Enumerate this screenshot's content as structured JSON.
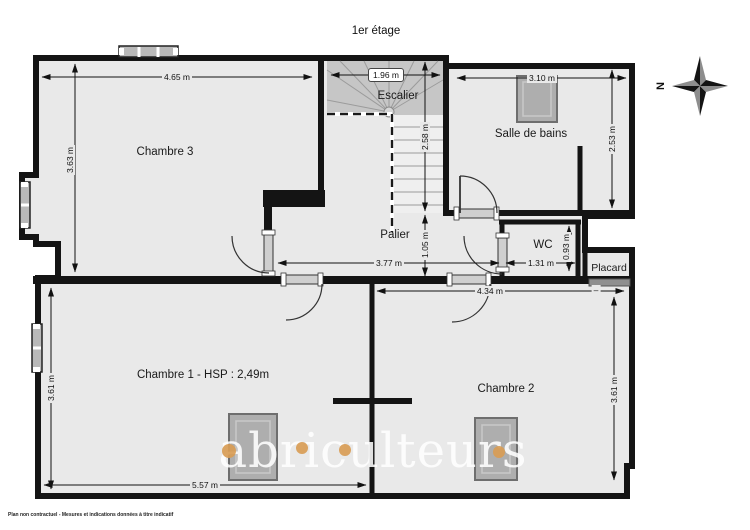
{
  "title": "1er étage",
  "disclaimer": "Plan non contractuel - Mesures et indications données à titre indicatif",
  "watermark": {
    "text": "abriculteurs",
    "accent_color": "#d89c55"
  },
  "compass": {
    "north_label": "N"
  },
  "rooms": {
    "chambre3": "Chambre 3",
    "escalier": "Escalier",
    "salle_de_bains": "Salle de bains",
    "palier": "Palier",
    "wc": "WC",
    "placard": "Placard",
    "chambre1": "Chambre 1 - HSP : 2,49m",
    "chambre2": "Chambre 2"
  },
  "dims": {
    "c3w": "4.65 m",
    "c3h": "3.63 m",
    "escw": "1.96 m",
    "esch": "2.58 m",
    "sdbw": "3.10 m",
    "sdbh": "2.53 m",
    "palh": "1.05 m",
    "palw": "3.77 m",
    "wcw": "1.31 m",
    "wch": "0.93 m",
    "c2w": "4.34 m",
    "placw": "–",
    "c1h": "3.61 m",
    "c1w": "5.57 m",
    "c2h": "3.61 m"
  },
  "colors": {
    "floor": "#e9e9e9",
    "wall": "#141414",
    "stairs_dark": "#c6c6c6",
    "fixture": "#aeaeae",
    "accent": "#d89c55"
  }
}
